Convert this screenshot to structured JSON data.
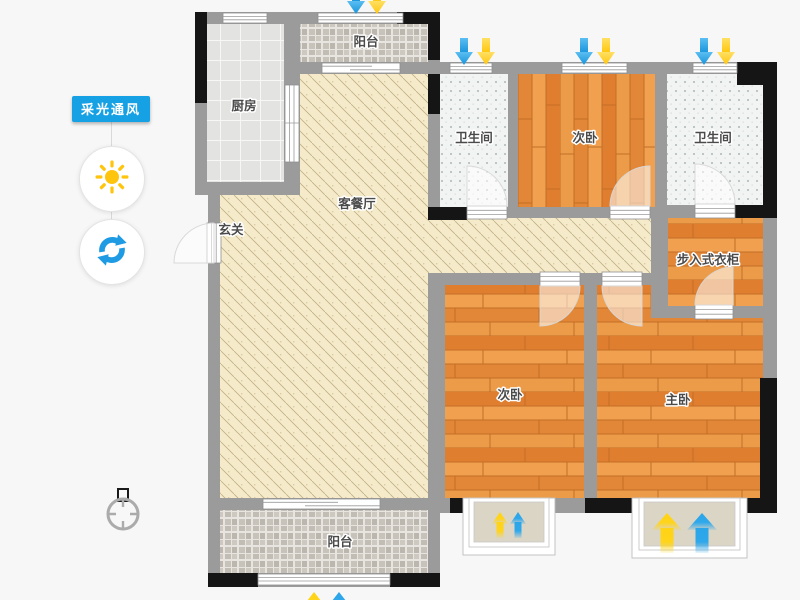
{
  "controls": {
    "badge_label": "采光通风",
    "badge_color": "#17A1E5",
    "buttons": [
      {
        "id": "daylight",
        "icon": "sun-icon",
        "color": "#FFC40C"
      },
      {
        "id": "rotate",
        "icon": "rotate-icon",
        "color": "#1F9BE4"
      }
    ]
  },
  "floorplan": {
    "rooms": [
      {
        "id": "kitchen",
        "label": "厨房"
      },
      {
        "id": "balcony-top",
        "label": "阳台"
      },
      {
        "id": "living-dining",
        "label": "客餐厅"
      },
      {
        "id": "entry-hall",
        "label": "玄关"
      },
      {
        "id": "bathroom-1",
        "label": "卫生间"
      },
      {
        "id": "bedroom-second-top",
        "label": "次卧"
      },
      {
        "id": "bathroom-2",
        "label": "卫生间"
      },
      {
        "id": "walkin-closet",
        "label": "步入式衣柜"
      },
      {
        "id": "bedroom-second-bottom",
        "label": "次卧"
      },
      {
        "id": "bedroom-master",
        "label": "主卧"
      },
      {
        "id": "balcony-bottom",
        "label": "阳台"
      }
    ],
    "indicators": {
      "light_arrow_color": "#FFD22E",
      "wind_arrow_color": "#2BA5E9"
    },
    "palette": {
      "wall": "#9B9B9B",
      "wall_dark": "#151515",
      "wood_floor": "#E6893C",
      "living_floor": "#F5EBCB",
      "kitchen_tile": "#E3E3E1",
      "bath_tile": "#F1F4F2",
      "balcony_tile": "#C7C3BA",
      "background": "#F7F7F7"
    }
  }
}
